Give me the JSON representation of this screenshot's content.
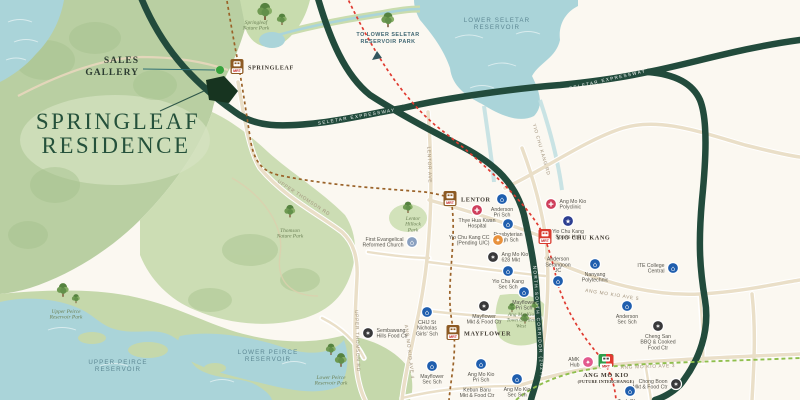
{
  "project": {
    "title_line1": "SPRINGLEAF",
    "title_line2": "RESIDENCE",
    "sales_gallery_line1": "SALES",
    "sales_gallery_line2": "GALLERY"
  },
  "colors": {
    "expressway": "#224b3c",
    "road": "#eadfc8",
    "water": "#aad4d9",
    "site": "#173420",
    "sales_gallery_dot": "#35a33c",
    "tel_line": "#9a6228",
    "nsl_line": "#e03a30",
    "crl_line": "#8fbf4d",
    "interchange_green": "#2f9e4b"
  },
  "categories": {
    "school": {
      "color": "#1f5eae",
      "glyph": "⌂"
    },
    "market": {
      "color": "#38383a",
      "glyph": "✶"
    },
    "medical": {
      "color": "#cf3f5c",
      "glyph": "✚"
    },
    "sports": {
      "color": "#2c3e90",
      "glyph": "★"
    },
    "mall": {
      "color": "#e25a8d",
      "glyph": "✦"
    },
    "cc": {
      "color": "#e8913c",
      "glyph": "✦"
    },
    "church": {
      "color": "#8aa0c0",
      "glyph": "⌂"
    }
  },
  "stations": [
    {
      "id": "springleaf",
      "label": "SPRINGLEAF",
      "line": "tel",
      "x": 237,
      "y": 67,
      "label_pos": "right"
    },
    {
      "id": "lentor",
      "label": "LENTOR",
      "line": "tel",
      "x": 450,
      "y": 199,
      "label_pos": "right"
    },
    {
      "id": "mayflower",
      "label": "MAYFLOWER",
      "line": "tel",
      "x": 453,
      "y": 333,
      "label_pos": "right"
    },
    {
      "id": "yio-chu-kang",
      "label": "YIO CHU KANG",
      "line": "nsl",
      "x": 545,
      "y": 237,
      "label_pos": "right"
    },
    {
      "id": "ang-mo-kio",
      "label": "ANG MO KIO",
      "sublabel": "(FUTURE INTERCHANGE)",
      "line": "interchange",
      "x": 606,
      "y": 362,
      "label_pos": "below"
    }
  ],
  "pois": [
    {
      "name": "anderson-pri-sch",
      "category": "school",
      "x": 502,
      "y": 199,
      "lines": [
        "Anderson",
        "Pri Sch"
      ],
      "label_pos": "below"
    },
    {
      "name": "thye-hua-kwan-hospital",
      "category": "medical",
      "x": 477,
      "y": 210,
      "lines": [
        "Thye Hua Kwan",
        "Hospital"
      ],
      "label_pos": "below"
    },
    {
      "name": "presbyterian-high-sch",
      "category": "school",
      "x": 508,
      "y": 224,
      "lines": [
        "Presbyterian",
        "High Sch"
      ],
      "label_pos": "below"
    },
    {
      "name": "yio-chu-kang-cc",
      "category": "cc",
      "x": 498,
      "y": 240,
      "lines": [
        "Yio Chu Kang CC",
        "(Pending U/C)"
      ],
      "label_pos": "left"
    },
    {
      "name": "ang-mo-kio-628-mkt",
      "category": "market",
      "x": 493,
      "y": 257,
      "lines": [
        "Ang Mo Kio",
        "628 Mkt"
      ],
      "label_pos": "right"
    },
    {
      "name": "yio-chu-kang-sec-sch",
      "category": "school",
      "x": 508,
      "y": 271,
      "lines": [
        "Yio Chu Kang",
        "Sec Sch"
      ],
      "label_pos": "below"
    },
    {
      "name": "mayflower-pri-sch",
      "category": "school",
      "x": 524,
      "y": 292,
      "lines": [
        "Mayflower",
        "Pri Sch"
      ],
      "label_pos": "below"
    },
    {
      "name": "mayflower-mkt-food-ctr",
      "category": "market",
      "x": 484,
      "y": 306,
      "lines": [
        "Mayflower",
        "Mkt & Food Ctr"
      ],
      "label_pos": "below"
    },
    {
      "name": "sembawang-hills-food-ctr",
      "category": "market",
      "x": 368,
      "y": 333,
      "lines": [
        "Sembawang",
        "Hills Food Ctr"
      ],
      "label_pos": "right"
    },
    {
      "name": "chij-st-nicholas-girls-sch",
      "category": "school",
      "x": 427,
      "y": 312,
      "lines": [
        "CHIJ St",
        "Nicholas",
        "Girls' Sch"
      ],
      "label_pos": "below"
    },
    {
      "name": "mayflower-sec-sch",
      "category": "school",
      "x": 432,
      "y": 366,
      "lines": [
        "Mayflower",
        "Sec Sch"
      ],
      "label_pos": "below"
    },
    {
      "name": "ang-mo-kio-pri-sch",
      "category": "school",
      "x": 481,
      "y": 364,
      "lines": [
        "Ang Mo Kio",
        "Pri Sch"
      ],
      "label_pos": "below"
    },
    {
      "name": "ang-mo-kio-sec-sch",
      "category": "school",
      "x": 517,
      "y": 379,
      "lines": [
        "Ang Mo Kio",
        "Sec Sch"
      ],
      "label_pos": "below"
    },
    {
      "name": "ang-mo-kio-polyclinic",
      "category": "medical",
      "x": 551,
      "y": 204,
      "lines": [
        "Ang Mo Kio",
        "Polyclinic"
      ],
      "label_pos": "right"
    },
    {
      "name": "yio-chu-kang-sports-hall",
      "category": "sports",
      "x": 568,
      "y": 221,
      "lines": [
        "Yio Chu Kang",
        "Sports Hall"
      ],
      "label_pos": "below"
    },
    {
      "name": "anderson-serangoon-jc",
      "category": "school",
      "x": 558,
      "y": 281,
      "lines": [
        "Anderson",
        "Serangoon",
        "JC"
      ],
      "label_pos": "above"
    },
    {
      "name": "nanyang-polytechnic",
      "category": "school",
      "x": 595,
      "y": 264,
      "lines": [
        "Nanyang",
        "Polytechnic"
      ],
      "label_pos": "below"
    },
    {
      "name": "ite-college-central",
      "category": "school",
      "x": 673,
      "y": 268,
      "lines": [
        "ITE College",
        "Central"
      ],
      "label_pos": "left"
    },
    {
      "name": "anderson-sec-sch",
      "category": "school",
      "x": 627,
      "y": 306,
      "lines": [
        "Anderson",
        "Sec Sch"
      ],
      "label_pos": "below"
    },
    {
      "name": "cheng-san-bbq-cooked-food-ctr",
      "category": "market",
      "x": 658,
      "y": 326,
      "lines": [
        "Cheng San",
        "BBQ & Cooked",
        "Food Ctr"
      ],
      "label_pos": "below"
    },
    {
      "name": "chong-boon-mkt-food-ctr",
      "category": "market",
      "x": 676,
      "y": 384,
      "lines": [
        "Chong Boon",
        "Mkt & Food Ctr"
      ],
      "label_pos": "left"
    },
    {
      "name": "amk-hub",
      "category": "mall",
      "x": 588,
      "y": 362,
      "lines": [
        "AMK",
        "Hub"
      ],
      "label_pos": "left"
    },
    {
      "name": "teck-ghee-pri-sch",
      "category": "school",
      "x": 630,
      "y": 391,
      "lines": [
        "Teck Ghee",
        "Pri Sch"
      ],
      "label_pos": "below"
    },
    {
      "name": "kebun-baru-mkt-food-ctr",
      "category": "market",
      "x": 477,
      "y": 406,
      "lines": [
        "Kebun Baru",
        "Mkt & Food Ctr"
      ],
      "label_pos": "above"
    },
    {
      "name": "first-evangelical-reformed-church",
      "category": "church",
      "x": 412,
      "y": 242,
      "lines": [
        "First Evangelical",
        "Reformed Church"
      ],
      "label_pos": "left"
    }
  ],
  "park_labels": [
    {
      "name": "springleaf-nature-park",
      "lines": [
        "Springleaf",
        "Nature Park"
      ],
      "x": 256,
      "y": 24
    },
    {
      "name": "thomson-nature-park",
      "lines": [
        "Thomson",
        "Nature Park"
      ],
      "x": 290,
      "y": 232
    },
    {
      "name": "lentor-hillock-park",
      "lines": [
        "Lentor",
        "Hillock",
        "Park"
      ],
      "x": 413,
      "y": 220
    },
    {
      "name": "upper-peirce-reservoir-park",
      "lines": [
        "Upper Peirce",
        "Reservoir Park"
      ],
      "x": 66,
      "y": 313
    },
    {
      "name": "lower-peirce-reservoir-park",
      "lines": [
        "Lower Peirce",
        "Reservoir Park"
      ],
      "x": 331,
      "y": 379
    },
    {
      "name": "amk-town-garden-west",
      "lines": [
        "Ang Mo Kio",
        "Town Garden",
        "West"
      ],
      "x": 521,
      "y": 316
    }
  ],
  "water_labels": [
    {
      "name": "lower-seletar-reservoir",
      "lines": [
        "LOWER SELETAR",
        "RESERVOIR"
      ],
      "x": 497,
      "y": 22
    },
    {
      "name": "upper-peirce-reservoir",
      "lines": [
        "UPPER PEIRCE",
        "RESERVOIR"
      ],
      "x": 118,
      "y": 364
    },
    {
      "name": "lower-peirce-reservoir",
      "lines": [
        "LOWER PEIRCE",
        "RESERVOIR"
      ],
      "x": 268,
      "y": 354
    }
  ],
  "direction_note": {
    "lines": [
      "TO LOWER SELETAR",
      "RESERVOIR PARK"
    ],
    "x": 388,
    "y": 36
  },
  "road_labels": [
    {
      "text": "SELETAR EXPRESSWAY",
      "x": 357,
      "y": 118,
      "rot": -10,
      "cls": "expwy-label"
    },
    {
      "text": "SELETAR EXPRESSWAY",
      "x": 608,
      "y": 81,
      "rot": -13,
      "cls": "expwy-label"
    },
    {
      "text": "NORTH-SOUTH CORRIDOR (2027)",
      "x": 537,
      "y": 322,
      "rot": 86,
      "cls": "expwy-label"
    },
    {
      "text": "UPPER THOMSON RD",
      "x": 303,
      "y": 199,
      "rot": 33,
      "cls": "road-label"
    },
    {
      "text": "UPPER THOMSON RD",
      "x": 356,
      "y": 341,
      "rot": 88,
      "cls": "road-label"
    },
    {
      "text": "YIO CHU KANG RD",
      "x": 540,
      "y": 150,
      "rot": 74,
      "cls": "road-label"
    },
    {
      "text": "LENTOR AVE",
      "x": 428,
      "y": 165,
      "rot": 88,
      "cls": "road-label"
    },
    {
      "text": "ANG MO KIO AVE 5",
      "x": 612,
      "y": 296,
      "rot": 9,
      "cls": "road-label"
    },
    {
      "text": "ANG MO KIO AVE 3",
      "x": 648,
      "y": 368,
      "rot": -2,
      "cls": "road-label"
    },
    {
      "text": "ANG MO KIO AVE 4",
      "x": 408,
      "y": 352,
      "rot": 83,
      "cls": "road-label"
    }
  ],
  "trees": [
    {
      "x": 265,
      "y": 14,
      "s": 1.5
    },
    {
      "x": 282,
      "y": 21,
      "s": 1.0
    },
    {
      "x": 388,
      "y": 22,
      "s": 1.3
    },
    {
      "x": 290,
      "y": 213,
      "s": 1.1
    },
    {
      "x": 408,
      "y": 209,
      "s": 1.0
    },
    {
      "x": 63,
      "y": 292,
      "s": 1.2
    },
    {
      "x": 76,
      "y": 300,
      "s": 0.8
    },
    {
      "x": 331,
      "y": 351,
      "s": 1.0
    },
    {
      "x": 341,
      "y": 362,
      "s": 1.2
    },
    {
      "x": 512,
      "y": 309,
      "s": 0.8
    },
    {
      "x": 525,
      "y": 320,
      "s": 0.9
    },
    {
      "x": 535,
      "y": 307,
      "s": 0.7
    }
  ]
}
